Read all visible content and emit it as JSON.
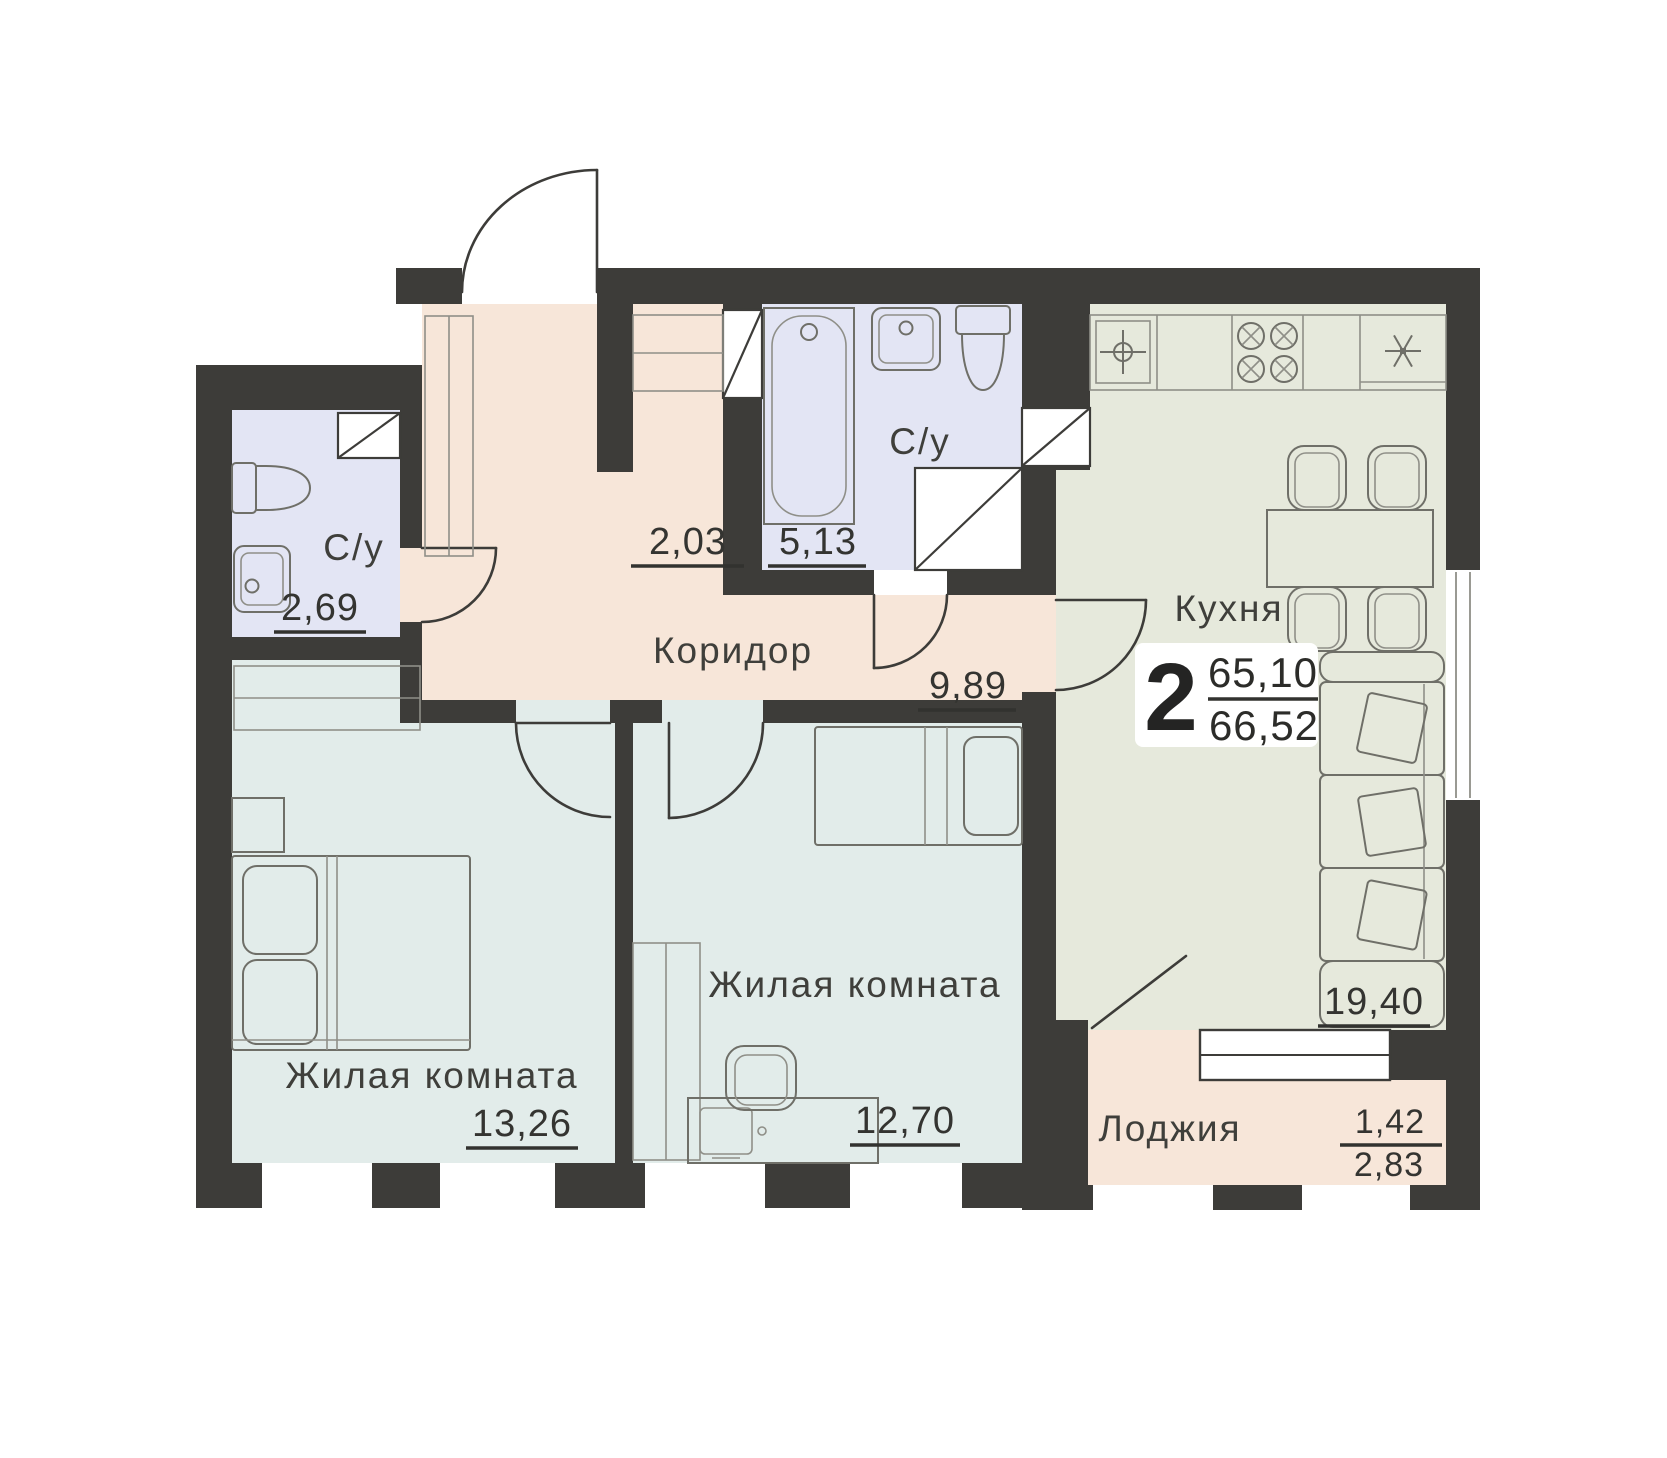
{
  "apartment": {
    "rooms_count": "2",
    "living_area": "65,10",
    "total_area": "66,52"
  },
  "rooms": {
    "bathroom_left": {
      "label": "С/у",
      "area": "2,69"
    },
    "closet": {
      "area": "2,03"
    },
    "bathroom_main": {
      "label": "С/у",
      "area": "5,13"
    },
    "corridor": {
      "label": "Коридор",
      "area": "9,89"
    },
    "kitchen": {
      "label": "Кухня",
      "area": "19,40"
    },
    "living_room_1": {
      "label": "Жилая комната",
      "area": "13,26"
    },
    "living_room_2": {
      "label": "Жилая комната",
      "area": "12,70"
    },
    "loggia": {
      "label": "Лоджия",
      "area_coefficient": "1,42",
      "area": "2,83"
    }
  },
  "colors": {
    "wall": "#3d3c39",
    "corridor_fill": "#f7e6d9",
    "bathroom_fill": "#e3e5f4",
    "living_fill": "#e2ecea",
    "kitchen_fill": "#e6e9dc",
    "text": "#3f3f3b"
  }
}
